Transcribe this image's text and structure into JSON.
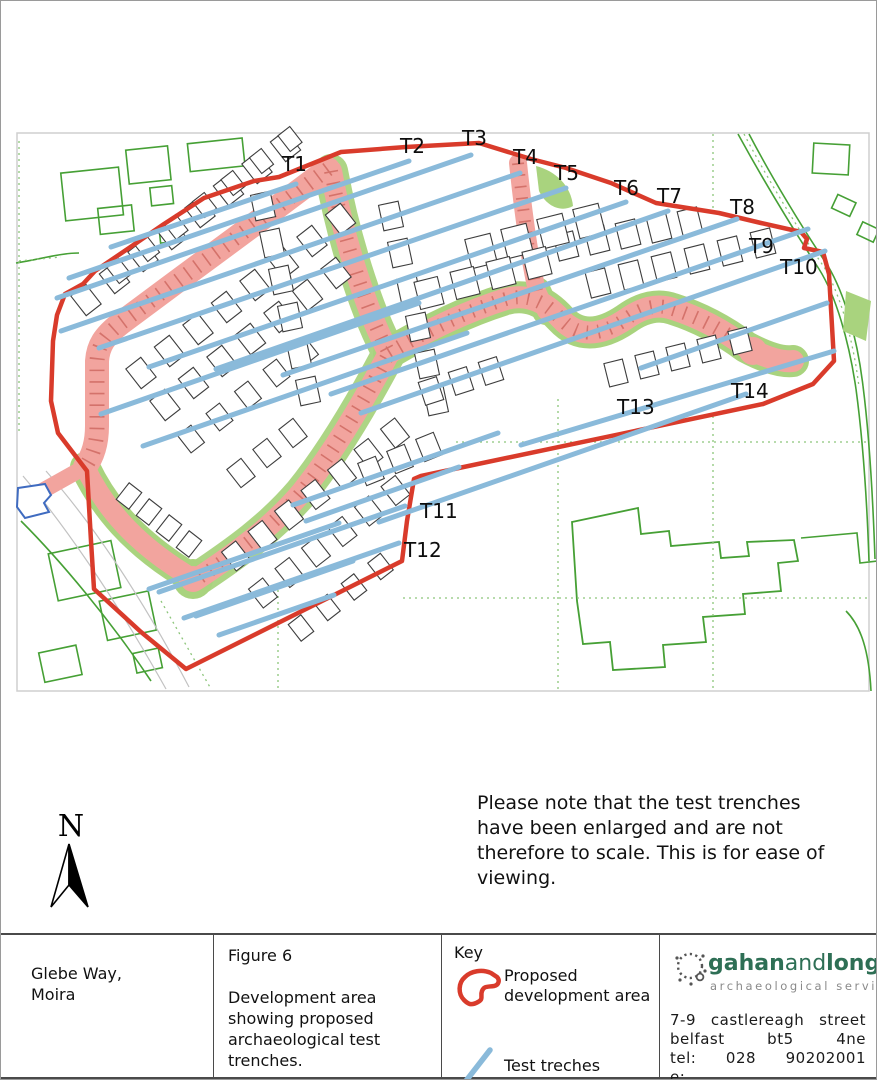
{
  "map": {
    "north_label": "N",
    "trenches": [
      {
        "label": "T1",
        "label_x": 281,
        "label_y": 170,
        "x1": 295,
        "y1": 183,
        "x2": 110,
        "y2": 246
      },
      {
        "label": "T2",
        "label_x": 399,
        "label_y": 152,
        "x1": 408,
        "y1": 160,
        "x2": 68,
        "y2": 277
      },
      {
        "label": "T3",
        "label_x": 461,
        "label_y": 144,
        "x1": 470,
        "y1": 154,
        "x2": 56,
        "y2": 297
      },
      {
        "label": "T4",
        "label_x": 512,
        "label_y": 163,
        "x1": 519,
        "y1": 172,
        "x2": 60,
        "y2": 330
      },
      {
        "label": "T5",
        "label_x": 553,
        "label_y": 179,
        "x1": 565,
        "y1": 187,
        "x2": 98,
        "y2": 347
      },
      {
        "label": "T6",
        "label_x": 613,
        "label_y": 194,
        "x1": 625,
        "y1": 201,
        "x2": 148,
        "y2": 366
      },
      {
        "label": "T7",
        "label_x": 656,
        "label_y": 202,
        "x1": 667,
        "y1": 210,
        "x2": 215,
        "y2": 368
      },
      {
        "label": "T8",
        "label_x": 729,
        "label_y": 213,
        "x1": 736,
        "y1": 218,
        "x2": 282,
        "y2": 374
      },
      {
        "label": "T9",
        "label_x": 748,
        "label_y": 252,
        "x1": 807,
        "y1": 228,
        "x2": 330,
        "y2": 393
      },
      {
        "label": "T10",
        "label_x": 779,
        "label_y": 273,
        "x1": 824,
        "y1": 250,
        "x2": 360,
        "y2": 412
      },
      {
        "label": "T11",
        "label_x": 419,
        "label_y": 517,
        "x1": 404,
        "y1": 505,
        "x2": 158,
        "y2": 591
      },
      {
        "label": "T12",
        "label_x": 403,
        "label_y": 556,
        "x1": 398,
        "y1": 542,
        "x2": 183,
        "y2": 617
      },
      {
        "label": "T13",
        "label_x": 616,
        "label_y": 413,
        "x1": 745,
        "y1": 393,
        "x2": 378,
        "y2": 521
      },
      {
        "label": "T14",
        "label_x": 730,
        "label_y": 397,
        "x1": 833,
        "y1": 350,
        "x2": 520,
        "y2": 444
      },
      {
        "label": "",
        "label_x": 0,
        "label_y": 0,
        "x1": 826,
        "y1": 302,
        "x2": 640,
        "y2": 367
      },
      {
        "label": "",
        "label_x": 0,
        "label_y": 0,
        "x1": 338,
        "y1": 522,
        "x2": 148,
        "y2": 588
      },
      {
        "label": "",
        "label_x": 0,
        "label_y": 0,
        "x1": 352,
        "y1": 560,
        "x2": 195,
        "y2": 615
      },
      {
        "label": "",
        "label_x": 0,
        "label_y": 0,
        "x1": 333,
        "y1": 594,
        "x2": 218,
        "y2": 634
      },
      {
        "label": "",
        "label_x": 0,
        "label_y": 0,
        "x1": 458,
        "y1": 466,
        "x2": 305,
        "y2": 520
      },
      {
        "label": "",
        "label_x": 0,
        "label_y": 0,
        "x1": 497,
        "y1": 432,
        "x2": 292,
        "y2": 504
      },
      {
        "label": "",
        "label_x": 0,
        "label_y": 0,
        "x1": 418,
        "y1": 302,
        "x2": 100,
        "y2": 413
      },
      {
        "label": "",
        "label_x": 0,
        "label_y": 0,
        "x1": 466,
        "y1": 332,
        "x2": 142,
        "y2": 445
      }
    ]
  },
  "note": {
    "text": "Please note that the test trenches have been enlarged and are not therefore to scale.  This is for ease of viewing."
  },
  "title_block": {
    "project": {
      "line1": "Glebe Way,",
      "line2": "Moira"
    },
    "figure": {
      "number": "Figure 6",
      "caption": "Development area showing proposed archaeological test trenches."
    },
    "key": {
      "title": "Key",
      "items": [
        {
          "symbol": "development-area-outline",
          "label": "Proposed development area"
        },
        {
          "symbol": "trench-line",
          "label": "Test treches"
        }
      ]
    },
    "company": {
      "name_part1": "gahan",
      "name_part2": "and",
      "name_part3": "long",
      "suffix": "ltd",
      "tagline": "archaeological services",
      "address_line1": "7-9 castlereagh street",
      "address_line2": "belfast bt5 4ne",
      "address_line3": "tel: 028 90202001",
      "address_line4": "e: info@gahanlong.co.uk"
    }
  },
  "colors": {
    "boundary_red": "#d93b2b",
    "trench_blue": "#8abada",
    "road_pink": "#f2a49e",
    "road_tick_red": "#cf6a62",
    "verge_green": "#a9d37e",
    "parcel_green": "#46a035",
    "parcel_green_light": "#8cc57a",
    "building_outline": "#3d3d3d",
    "logo_green": "#2e6f55",
    "blue_parcel": "#3f6bc0"
  }
}
